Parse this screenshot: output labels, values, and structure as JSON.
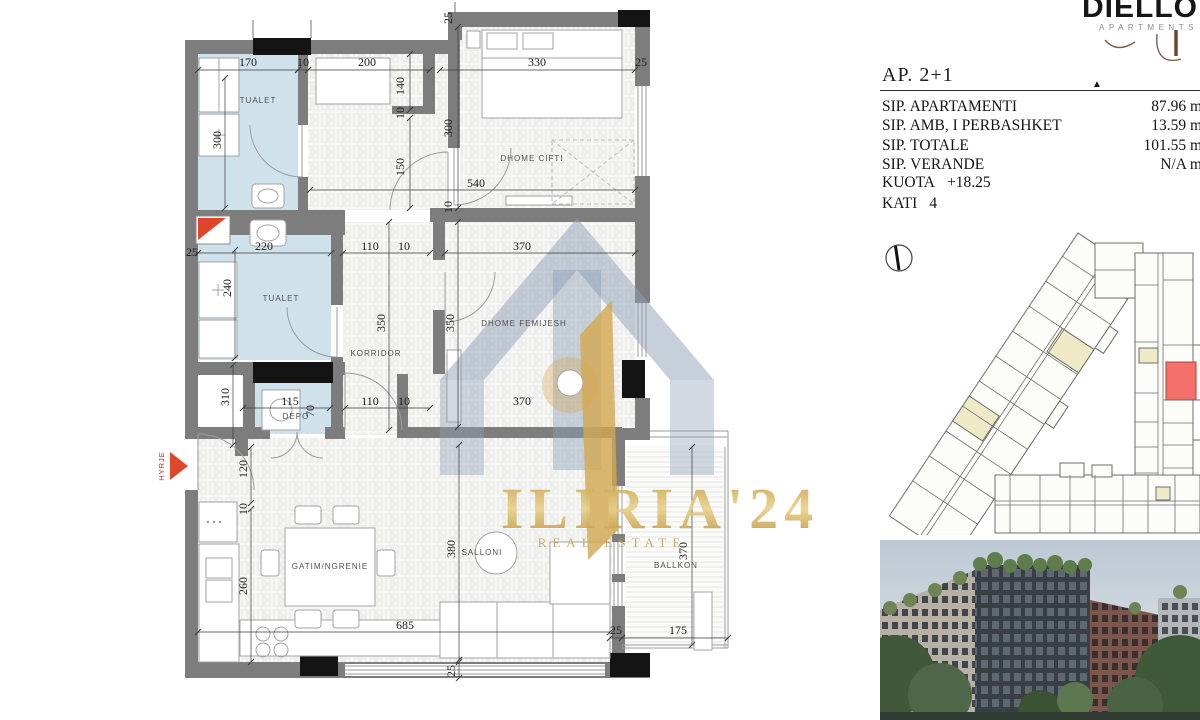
{
  "brand": {
    "name": "DIELLON",
    "tagline": "APARTMENTS 2"
  },
  "info": {
    "title": "AP. 2+1",
    "rows": [
      {
        "label": "SIP. APARTAMENTI",
        "value": "87.96 m"
      },
      {
        "label": "SIP. AMB, I PERBASHKET",
        "value": "13.59 m"
      },
      {
        "label": "SIP. TOTALE",
        "value": "101.55 m"
      },
      {
        "label": "SIP. VERANDE",
        "value": "N/A m"
      }
    ],
    "kuota_label": "KUOTA",
    "kuota_value": "+18.25",
    "kati_label": "KATI",
    "kati_value": "4"
  },
  "floor_plan": {
    "entrance_label": "HYRJE",
    "watermark_line1": "ILIRIA'24",
    "watermark_line2": "REAL ESTATE",
    "rooms": [
      {
        "t": "TUALET",
        "x": 258,
        "y": 103
      },
      {
        "t": "DHOME CIFTI",
        "x": 532,
        "y": 161
      },
      {
        "t": "TUALET",
        "x": 281,
        "y": 301
      },
      {
        "t": "KORRIDOR",
        "x": 376,
        "y": 356
      },
      {
        "t": "DHOME FEMIJESH",
        "x": 524,
        "y": 326
      },
      {
        "t": "DEPO",
        "x": 296,
        "y": 419
      },
      {
        "t": "GATIM/NGRENIE",
        "x": 330,
        "y": 569
      },
      {
        "t": "SALLONI",
        "x": 482,
        "y": 555
      },
      {
        "t": "BALLKON",
        "x": 676,
        "y": 568
      }
    ],
    "dimensions": [
      {
        "t": "170",
        "x": 248,
        "y": 66
      },
      {
        "t": "10",
        "x": 303,
        "y": 66
      },
      {
        "t": "200",
        "x": 367,
        "y": 66
      },
      {
        "t": "330",
        "x": 537,
        "y": 66
      },
      {
        "t": "25",
        "x": 641,
        "y": 66
      },
      {
        "t": "140",
        "x": 404,
        "y": 86,
        "r": 1
      },
      {
        "t": "25",
        "x": 452,
        "y": 18,
        "r": 1
      },
      {
        "t": "300",
        "x": 221,
        "y": 140,
        "r": 1
      },
      {
        "t": "300",
        "x": 452,
        "y": 128,
        "r": 1
      },
      {
        "t": "10",
        "x": 404,
        "y": 113,
        "r": 1
      },
      {
        "t": "150",
        "x": 404,
        "y": 167,
        "r": 1
      },
      {
        "t": "540",
        "x": 476,
        "y": 187
      },
      {
        "t": "10",
        "x": 452,
        "y": 207,
        "r": 1
      },
      {
        "t": "25",
        "x": 192,
        "y": 256
      },
      {
        "t": "220",
        "x": 264,
        "y": 250
      },
      {
        "t": "110",
        "x": 370,
        "y": 250
      },
      {
        "t": "10",
        "x": 404,
        "y": 250
      },
      {
        "t": "370",
        "x": 522,
        "y": 250
      },
      {
        "t": "240",
        "x": 231,
        "y": 288,
        "r": 1
      },
      {
        "t": "350",
        "x": 385,
        "y": 323,
        "r": 1
      },
      {
        "t": "350",
        "x": 454,
        "y": 323,
        "r": 1
      },
      {
        "t": "310",
        "x": 229,
        "y": 397,
        "r": 1
      },
      {
        "t": "115",
        "x": 290,
        "y": 405
      },
      {
        "t": "70",
        "x": 314,
        "y": 411,
        "r": 1
      },
      {
        "t": "110",
        "x": 370,
        "y": 405
      },
      {
        "t": "10",
        "x": 404,
        "y": 405
      },
      {
        "t": "370",
        "x": 522,
        "y": 405
      },
      {
        "t": "120",
        "x": 247,
        "y": 469,
        "r": 1
      },
      {
        "t": "10",
        "x": 247,
        "y": 509,
        "r": 1
      },
      {
        "t": "260",
        "x": 247,
        "y": 586,
        "r": 1
      },
      {
        "t": "685",
        "x": 405,
        "y": 629
      },
      {
        "t": "25",
        "x": 455,
        "y": 671,
        "r": 1
      },
      {
        "t": "380",
        "x": 455,
        "y": 549,
        "r": 1
      },
      {
        "t": "25",
        "x": 616,
        "y": 634
      },
      {
        "t": "175",
        "x": 678,
        "y": 634
      },
      {
        "t": "370",
        "x": 687,
        "y": 551,
        "r": 1
      }
    ]
  },
  "colors": {
    "wall": "#7d7d7d",
    "wet_room": "#cfe2ec",
    "accent_red": "#e0462c",
    "gold": "#cda24c",
    "slate": "#8fa0b8",
    "site_highlight": "#f4716b"
  }
}
